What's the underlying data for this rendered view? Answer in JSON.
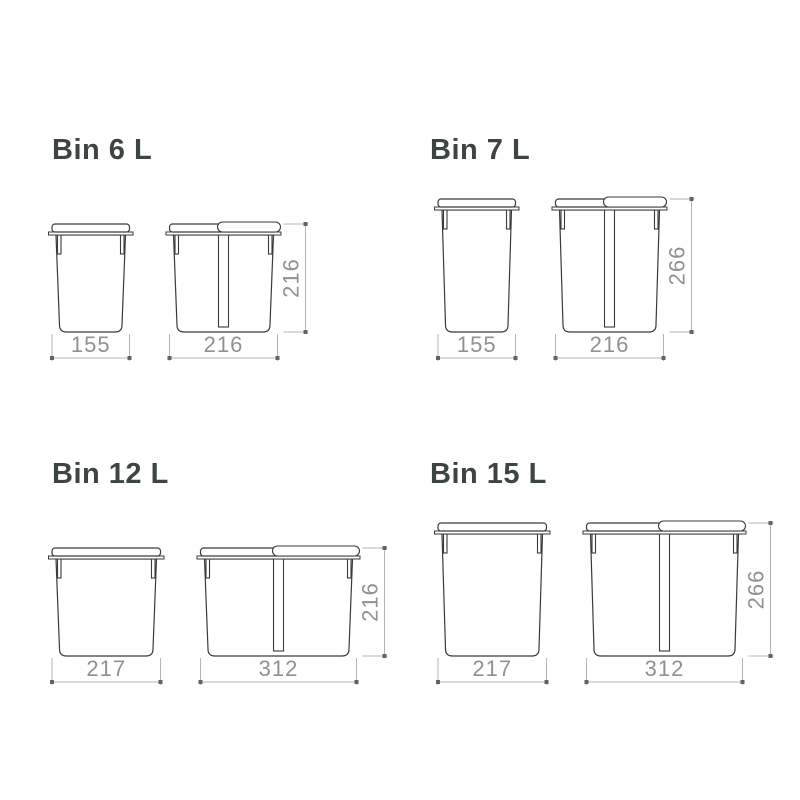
{
  "page": {
    "background": "#ffffff"
  },
  "colors": {
    "title_text": "#3d4543",
    "drawing_stroke": "#3a3a3a",
    "drawing_fill": "#ffffff",
    "dimension_line": "#b4b6b6",
    "dimension_text": "#8f9192",
    "dimension_dot": "#636363"
  },
  "units": "mm",
  "panels": [
    {
      "id": "bin-6l",
      "title": "Bin 6 L",
      "front_width": "155",
      "side_width": "216",
      "height": "216",
      "front_width_mm": 155,
      "side_width_mm": 216,
      "height_mm": 216
    },
    {
      "id": "bin-7l",
      "title": "Bin 7 L",
      "front_width": "155",
      "side_width": "216",
      "height": "266",
      "front_width_mm": 155,
      "side_width_mm": 216,
      "height_mm": 266
    },
    {
      "id": "bin-12l",
      "title": "Bin 12 L",
      "front_width": "217",
      "side_width": "312",
      "height": "216",
      "front_width_mm": 217,
      "side_width_mm": 312,
      "height_mm": 216
    },
    {
      "id": "bin-15l",
      "title": "Bin 15 L",
      "front_width": "217",
      "side_width": "312",
      "height": "266",
      "front_width_mm": 217,
      "side_width_mm": 312,
      "height_mm": 266
    }
  ]
}
